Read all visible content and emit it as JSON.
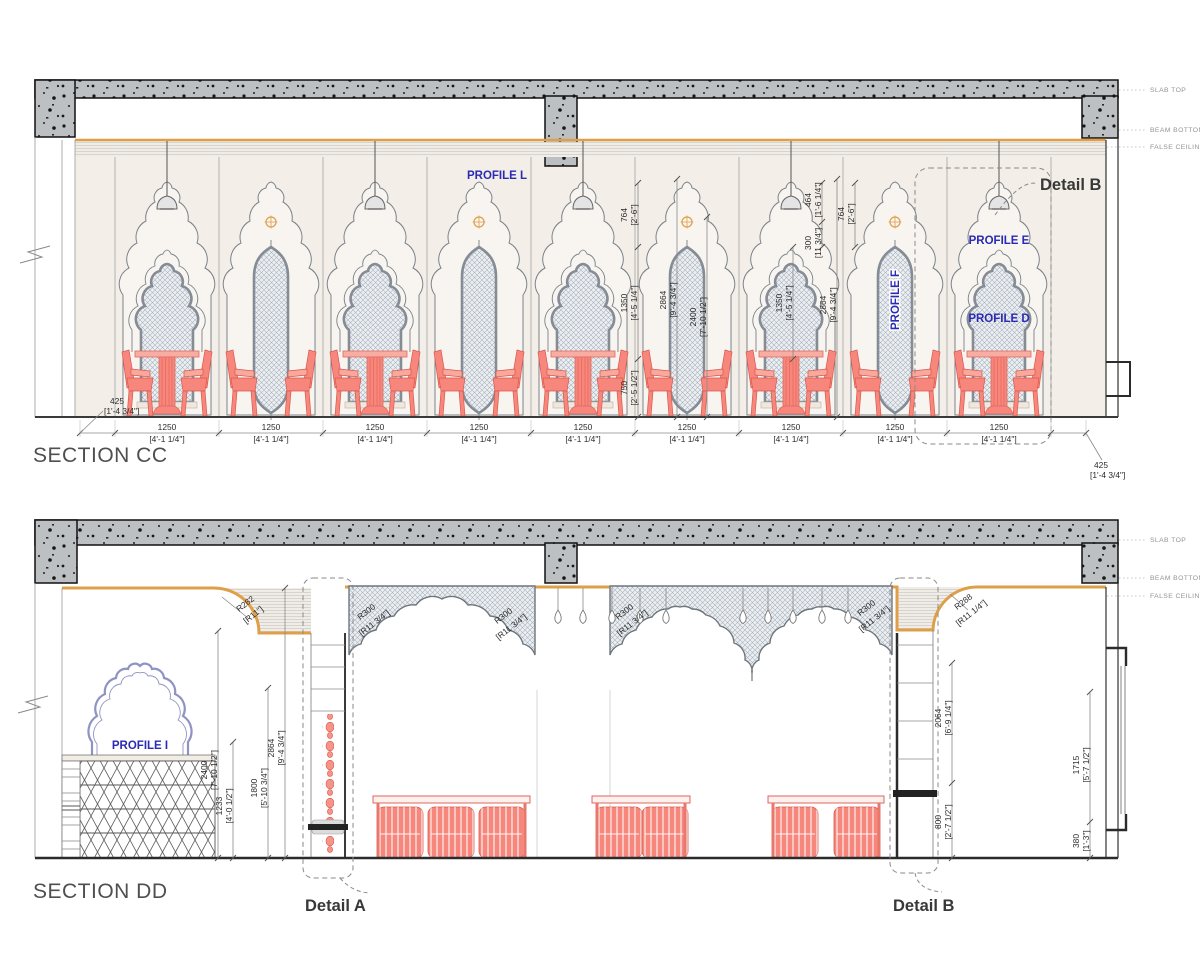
{
  "sheet": {
    "type_label": "interior elevation sections",
    "colors": {
      "profile_blue": "#2a2ab5",
      "coral": "#f7877c",
      "orange_line": "#df9f48",
      "concrete": "#bcbfc2"
    }
  },
  "section_cc": {
    "title": "SECTION CC",
    "side_labels": {
      "slab_top": "SLAB TOP",
      "beam_bottom": "BEAM BOTTOM",
      "false_ceiling": "FALSE CEILING"
    },
    "labels": {
      "profile_l": "PROFILE L",
      "profile_e": "PROFILE E",
      "profile_d": "PROFILE D",
      "profile_f": "PROFILE F",
      "detail_b": "Detail B"
    },
    "dims": {
      "d425": {
        "mm": "425",
        "ft": "[1'-4 3/4\"]"
      },
      "bay": {
        "mm": "1250",
        "ft": "[4'-1 1/4\"]"
      },
      "d764": {
        "mm": "764",
        "ft": "[2'-6\"]"
      },
      "d1350": {
        "mm": "1350",
        "ft": "[4'-5 1/4\"]"
      },
      "d2864": {
        "mm": "2864",
        "ft": "[9'-4 3/4\"]"
      },
      "d2400": {
        "mm": "2400",
        "ft": "[7'-10 1/2\"]"
      },
      "d750": {
        "mm": "750",
        "ft": "[2'-5 1/2\"]"
      },
      "d300": {
        "mm": "300",
        "ft": "[11 3/4\"]"
      },
      "d464": {
        "mm": "464",
        "ft": "[1'-6 1/4\"]"
      }
    }
  },
  "section_dd": {
    "title": "SECTION DD",
    "side_labels": {
      "slab_top": "SLAB TOP",
      "beam_bottom": "BEAM BOTTOM",
      "false_ceiling": "FALSE CEILING"
    },
    "labels": {
      "profile_i": "PROFILE I",
      "detail_a": "Detail A",
      "detail_b": "Detail B"
    },
    "dims": {
      "r282": {
        "r": "R282",
        "ft": "[R11\"]"
      },
      "r300": {
        "r": "R300",
        "ft": "[R11 3/4\"]"
      },
      "r288": {
        "r": "R288",
        "ft": "[R11 1/4\"]"
      },
      "d2400": {
        "mm": "2400",
        "ft": "[7'-10 1/2\"]"
      },
      "d1233": {
        "mm": "1233",
        "ft": "[4'-0 1/2\"]"
      },
      "d1800": {
        "mm": "1800",
        "ft": "[5'-10 3/4\"]"
      },
      "d2864": {
        "mm": "2864",
        "ft": "[9'-4 3/4\"]"
      },
      "d2064": {
        "mm": "2064",
        "ft": "[6'-9 1/4\"]"
      },
      "d800": {
        "mm": "800",
        "ft": "[2'-7 1/2\"]"
      },
      "d1715": {
        "mm": "1715",
        "ft": "[5'-7 1/2\"]"
      },
      "d380": {
        "mm": "380",
        "ft": "[1'-3\"]"
      }
    }
  }
}
